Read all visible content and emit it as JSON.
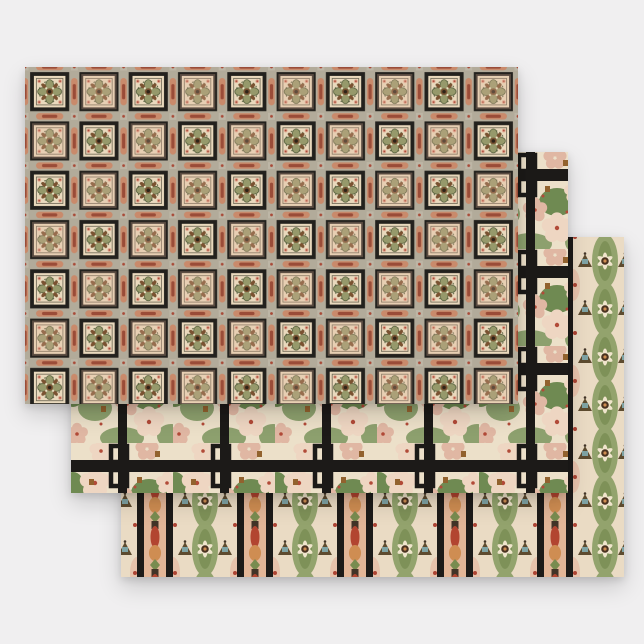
{
  "product": {
    "name": "wrapping-paper-flat-sheet-set",
    "sheet_count": 3,
    "description": "Three overlapping flat sheets of vintage victorian tile-and-floral patterned wrapping paper on a light grey backdrop"
  },
  "canvas": {
    "width": 644,
    "height": 644
  },
  "sheets": [
    {
      "id": "tile-grid",
      "label": "Victorian tile grid pattern sheet",
      "x": 25,
      "y": 67,
      "w": 493,
      "h": 337,
      "z": 3
    },
    {
      "id": "floral-lattice",
      "label": "Dogwood floral with black lattice sheet",
      "x": 71,
      "y": 152,
      "w": 497,
      "h": 341,
      "z": 2
    },
    {
      "id": "floral-stripes",
      "label": "Floral stripe with black bands sheet",
      "x": 121,
      "y": 237,
      "w": 503,
      "h": 340,
      "z": 1
    }
  ],
  "palette": {
    "bg": "#f0eff0",
    "s1-band": "#b2ab9a",
    "s1-orn": "#c98a6b",
    "s1-orn-dark": "#9a4c38",
    "s1-cross": "#bdb6a6",
    "s1-frame": "#23211d",
    "s1-tile": "#e9d9bd",
    "s1-tile-alt": "#e0b49a",
    "s1-inner": "#6b6350",
    "s1-petal": "#96996b",
    "s1-petal-edge": "#4f5a38",
    "s1-brown": "#7a5231",
    "s1-center": "#2e2418",
    "s1-cream": "#f1e4c8",
    "s1-corner-red": "#a84a38",
    "s1-corner-pink": "#dda089",
    "s2-bg": "#ece0c9",
    "s2-petal": "#eed6c2",
    "s2-petal-deep": "#e0b7a3",
    "s2-green": "#8da06e",
    "s2-green-dark": "#6f8a52",
    "s2-red": "#b24a38",
    "s2-brown": "#92622e",
    "s2-black": "#1c1a18",
    "s3-panel": "#eadbc4",
    "s3-green": "#93a36d",
    "s3-green-dark": "#7e9158",
    "s3-star-petal": "#efe4cb",
    "s3-star-center": "#4a3220",
    "s3-pagoda": "#5d4b2f",
    "s3-teal": "#7fa3a4",
    "s3-red": "#ad4434",
    "s3-tcol": "#e2b698",
    "s3-tred": "#b24530",
    "s3-torange": "#cf8d52",
    "s3-tgreen": "#798c50",
    "s3-tdark": "#423427",
    "s3-black": "#1d1b19",
    "s3-pink": "#e8c3ac"
  }
}
